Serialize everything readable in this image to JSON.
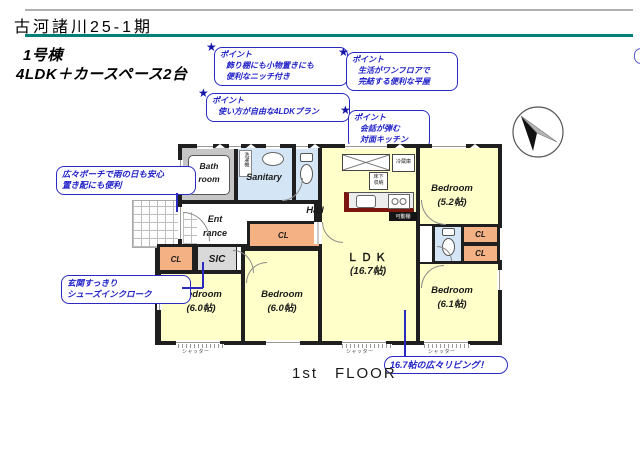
{
  "header": {
    "title": "古河諸川25-1期",
    "building_no": "1号棟",
    "plan_type": "4LDK＋カースペース2台"
  },
  "points": {
    "label": "ポイント",
    "niche": "飾り棚にも小物置きにも\n便利なニッチ付き",
    "one_floor": "生活がワンフロアで\n完結する便利な平屋",
    "free_plan": "使い方が自由な4LDKプラン",
    "kitchen": "会話が弾む\n対面キッチン"
  },
  "callouts": {
    "porch": "広々ポーチで雨の日も安心\n置き配にも便利",
    "entrance": "玄関すっきり\nシューズインクローク",
    "living": "16.7帖の広々リビング！"
  },
  "rooms": {
    "bath": "Bath\nroom",
    "sanitary": "Sanitary",
    "hall": "Hall",
    "entrance": "Ent\nrance",
    "sic": "SIC",
    "cl": "CL",
    "bedroom_60": "Bedroom\n(6.0帖)",
    "bedroom_52": "Bedroom\n(5.2帖)",
    "bedroom_61": "Bedroom\n(6.1帖)",
    "ldk_name": "ＬＤＫ",
    "ldk_size": "(16.7帖)"
  },
  "fixtures": {
    "laundry": "洗濯機",
    "fridge": "冷蔵庫",
    "floor_storage": "床下\n収納",
    "movable_shelf": "可動棚",
    "shutter": "シャッター"
  },
  "footer": {
    "floor": "1st　FLOOR"
  },
  "colors": {
    "accent_teal": "#00807a",
    "annotation_blue": "#2121c8",
    "room_yellow": "#ffffca",
    "closet_orange": "#F4B183",
    "water_blue": "#d4e5f5",
    "wall_black": "#1f1f1f"
  }
}
